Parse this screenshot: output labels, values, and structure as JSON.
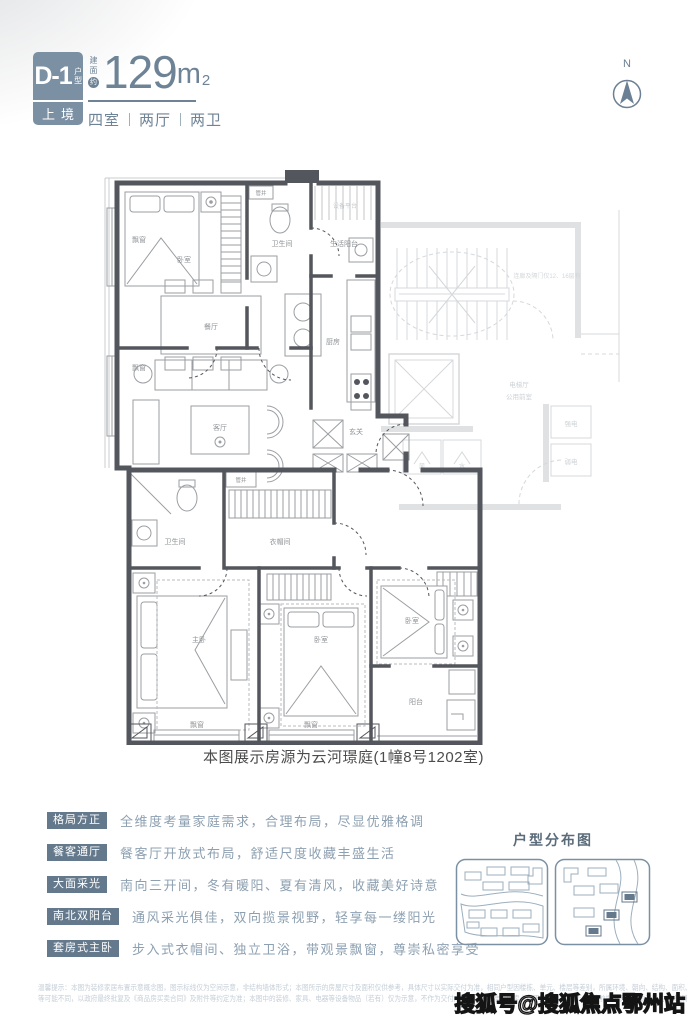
{
  "header": {
    "unit_code": "D-1",
    "unit_code_suffix": "户型",
    "series": "上境",
    "area_prefix_1": "建",
    "area_prefix_2": "面",
    "area_prefix_3": "约",
    "area_value": "129",
    "area_unit": "m",
    "area_power": "2",
    "room_1": "四室",
    "room_2": "两厅",
    "room_3": "两卫",
    "north_label": "N"
  },
  "floorplan": {
    "caption": "本图展示房源为云河璟庭(1幢8号1202室)",
    "labels": {
      "bay_window": "飘窗",
      "bedroom": "卧室",
      "pipe_shaft": "管井",
      "bathroom": "卫生间",
      "service_balcony": "生活阳台",
      "equipment_platform": "设备平台",
      "kitchen": "厨房",
      "dining": "餐厅",
      "living": "客厅",
      "foyer": "玄关",
      "closet": "衣帽间",
      "master": "主卧",
      "balcony": "阳台",
      "elevator_hall": "电梯厅",
      "shared_lobby": "公用前室",
      "strong_power": "强电",
      "weak_power": "弱电",
      "wind": "风",
      "water": "水",
      "corridor_note": "连廊及隔门仅12、16层有"
    }
  },
  "features": {
    "items": [
      {
        "tag": "格局方正",
        "desc": "全维度考量家庭需求，合理布局，尽显优雅格调"
      },
      {
        "tag": "餐客通厅",
        "desc": "餐客厅开放式布局，舒适尺度收藏丰盛生活"
      },
      {
        "tag": "大面采光",
        "desc": "南向三开间，冬有暖阳、夏有清风，收藏美好诗意"
      },
      {
        "tag": "南北双阳台",
        "desc": "通风采光俱佳，双向揽景视野，轻享每一缕阳光"
      },
      {
        "tag": "套房式主卧",
        "desc": "步入式衣帽间、独立卫浴，带观景飘窗，尊崇私密享受"
      }
    ]
  },
  "distribution": {
    "title": "户型分布图"
  },
  "disclaimer": {
    "line1": "温馨提示：本图为装修家居布置示意概念图，图示标线仅为空间示意，非结构墙体形式；本图所示的房屋尺寸及面积仅供参考，具体尺寸以实际交付为准，相同户型因楼栋、单元、楼层等差别，所属环境、朝向、结构、面积、管道位置、外立面、设备平台",
    "line2": "等可能不同，以政府最终批复及《商品房买卖合同》及附件等约定为准；本图中的装修、家具、电器等设备物品（若有）仅为示意，不作为交付内容和交付标准。出卖人在不违反国家法律法规的前提下保留对本资料的最终解释权。"
  },
  "watermark": "搜狐号@搜狐焦点鄂州站",
  "colors": {
    "accent": "#64798c",
    "headline": "#6e8396",
    "wall": "#53565c",
    "core_gray": "#d5d8db"
  }
}
